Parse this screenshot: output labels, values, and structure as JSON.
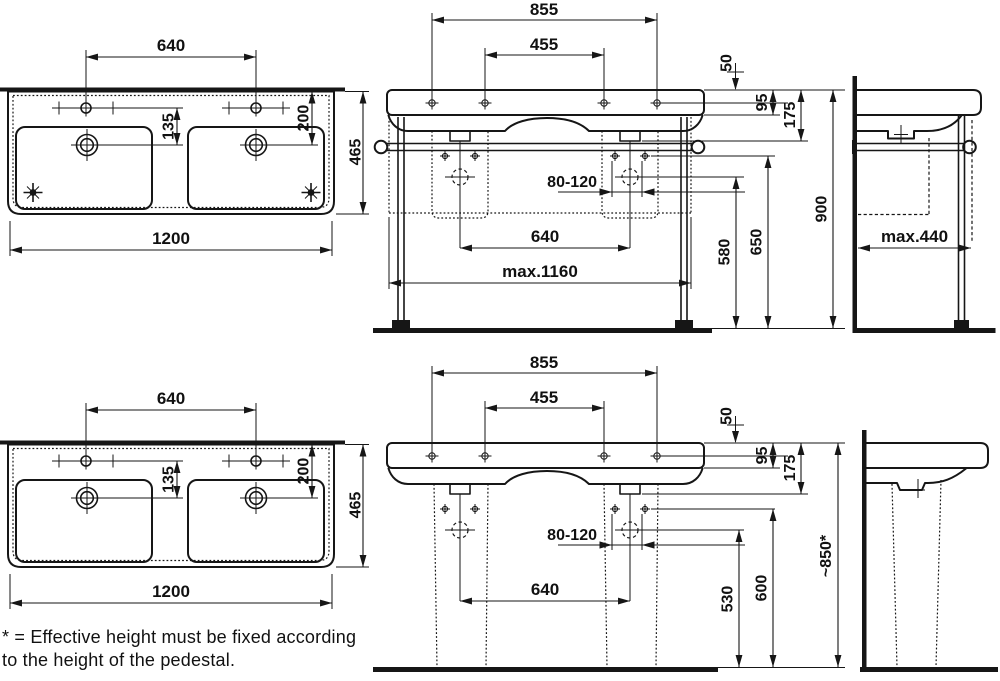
{
  "drawing_title": "Double countertop washbasin - technical dimension drawing",
  "colors": {
    "ink": "#161616",
    "background": "#ffffff"
  },
  "units": "mm",
  "views": {
    "plan": {
      "label": "washbasin plan view",
      "dims": {
        "faucet_spacing": "640",
        "faucet_to_drain": "135",
        "edge_to_drain": "200",
        "depth": "465",
        "width": "1200"
      }
    },
    "front_common": {
      "label": "front view shared dimensions",
      "dims": {
        "holes_outer": "855",
        "holes_inner": "455",
        "top_clearance": "50",
        "apron_height": "95",
        "rail_offset": "175",
        "drain_range": "80-120",
        "drain_spacing": "640"
      }
    },
    "front_legs": {
      "label": "front view with towel-rail frame",
      "dims": {
        "frame_width": "max.1160",
        "drain_height": "580",
        "fixing_height": "650",
        "rim_height": "900"
      }
    },
    "side_legs": {
      "label": "side view with frame",
      "dims": {
        "depth": "max.440"
      }
    },
    "front_pedestal": {
      "label": "front view with pedestals",
      "dims": {
        "drain_height": "530",
        "fixing_height": "600",
        "rim_height": "~850*"
      }
    },
    "side_pedestal": {
      "label": "side view with pedestal",
      "dims": {}
    }
  },
  "footnote": {
    "line1": "* = Effective height must be fixed according",
    "line2": "to the height of the pedestal."
  }
}
